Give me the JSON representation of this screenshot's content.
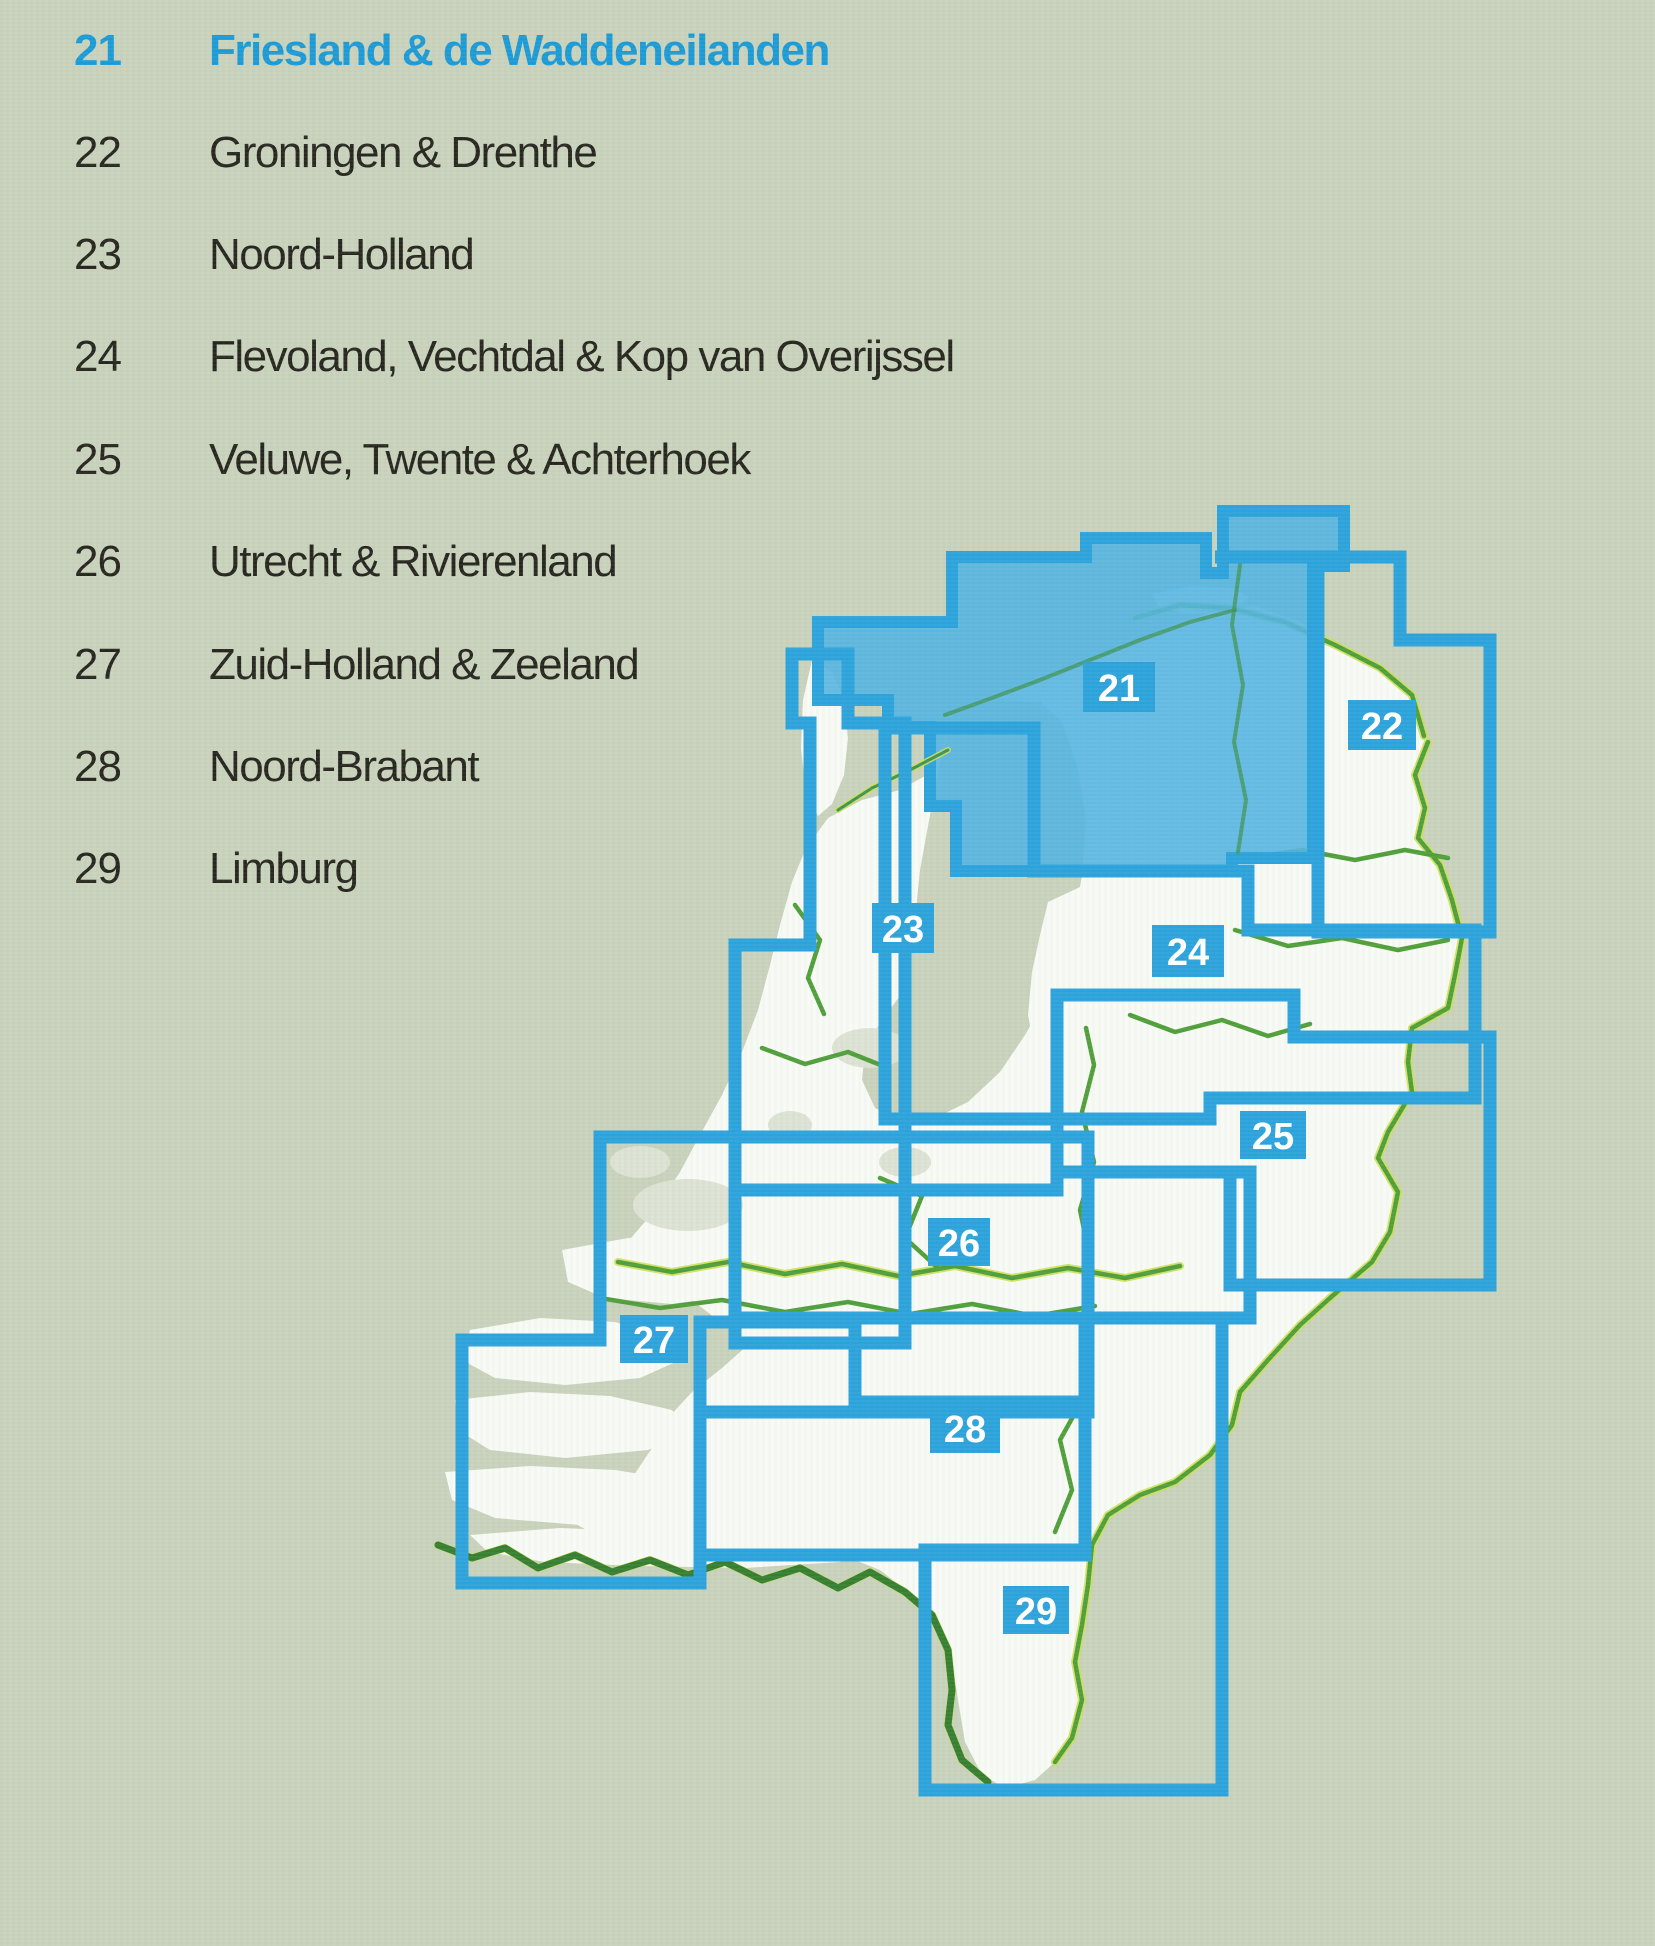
{
  "page": {
    "type": "atlas-region-index",
    "background_color": "#c9d2bc",
    "accent_blue": "#2ba3dc",
    "highlight_fill_blue": "#52b4e2",
    "highlight_text_blue": "#1a9bd7",
    "border_green": "#4f9f3a",
    "border_yellow": "#cde055",
    "land_color": "#f8faf5"
  },
  "legend": {
    "items": [
      {
        "number": "21",
        "name": "Friesland & de Waddeneilanden",
        "highlighted": true
      },
      {
        "number": "22",
        "name": "Groningen & Drenthe",
        "highlighted": false
      },
      {
        "number": "23",
        "name": "Noord-Holland",
        "highlighted": false
      },
      {
        "number": "24",
        "name": "Flevoland, Vechtdal & Kop van Overijssel",
        "highlighted": false
      },
      {
        "number": "25",
        "name": "Veluwe, Twente & Achterhoek",
        "highlighted": false
      },
      {
        "number": "26",
        "name": "Utrecht & Rivierenland",
        "highlighted": false
      },
      {
        "number": "27",
        "name": "Zuid-Holland & Zeeland",
        "highlighted": false
      },
      {
        "number": "28",
        "name": "Noord-Brabant",
        "highlighted": false
      },
      {
        "number": "29",
        "name": "Limburg",
        "highlighted": false
      }
    ]
  },
  "map": {
    "highlighted_region": "21",
    "labels": [
      {
        "number": "21"
      },
      {
        "number": "22"
      },
      {
        "number": "23"
      },
      {
        "number": "24"
      },
      {
        "number": "25"
      },
      {
        "number": "26"
      },
      {
        "number": "27"
      },
      {
        "number": "28"
      },
      {
        "number": "29"
      }
    ]
  }
}
